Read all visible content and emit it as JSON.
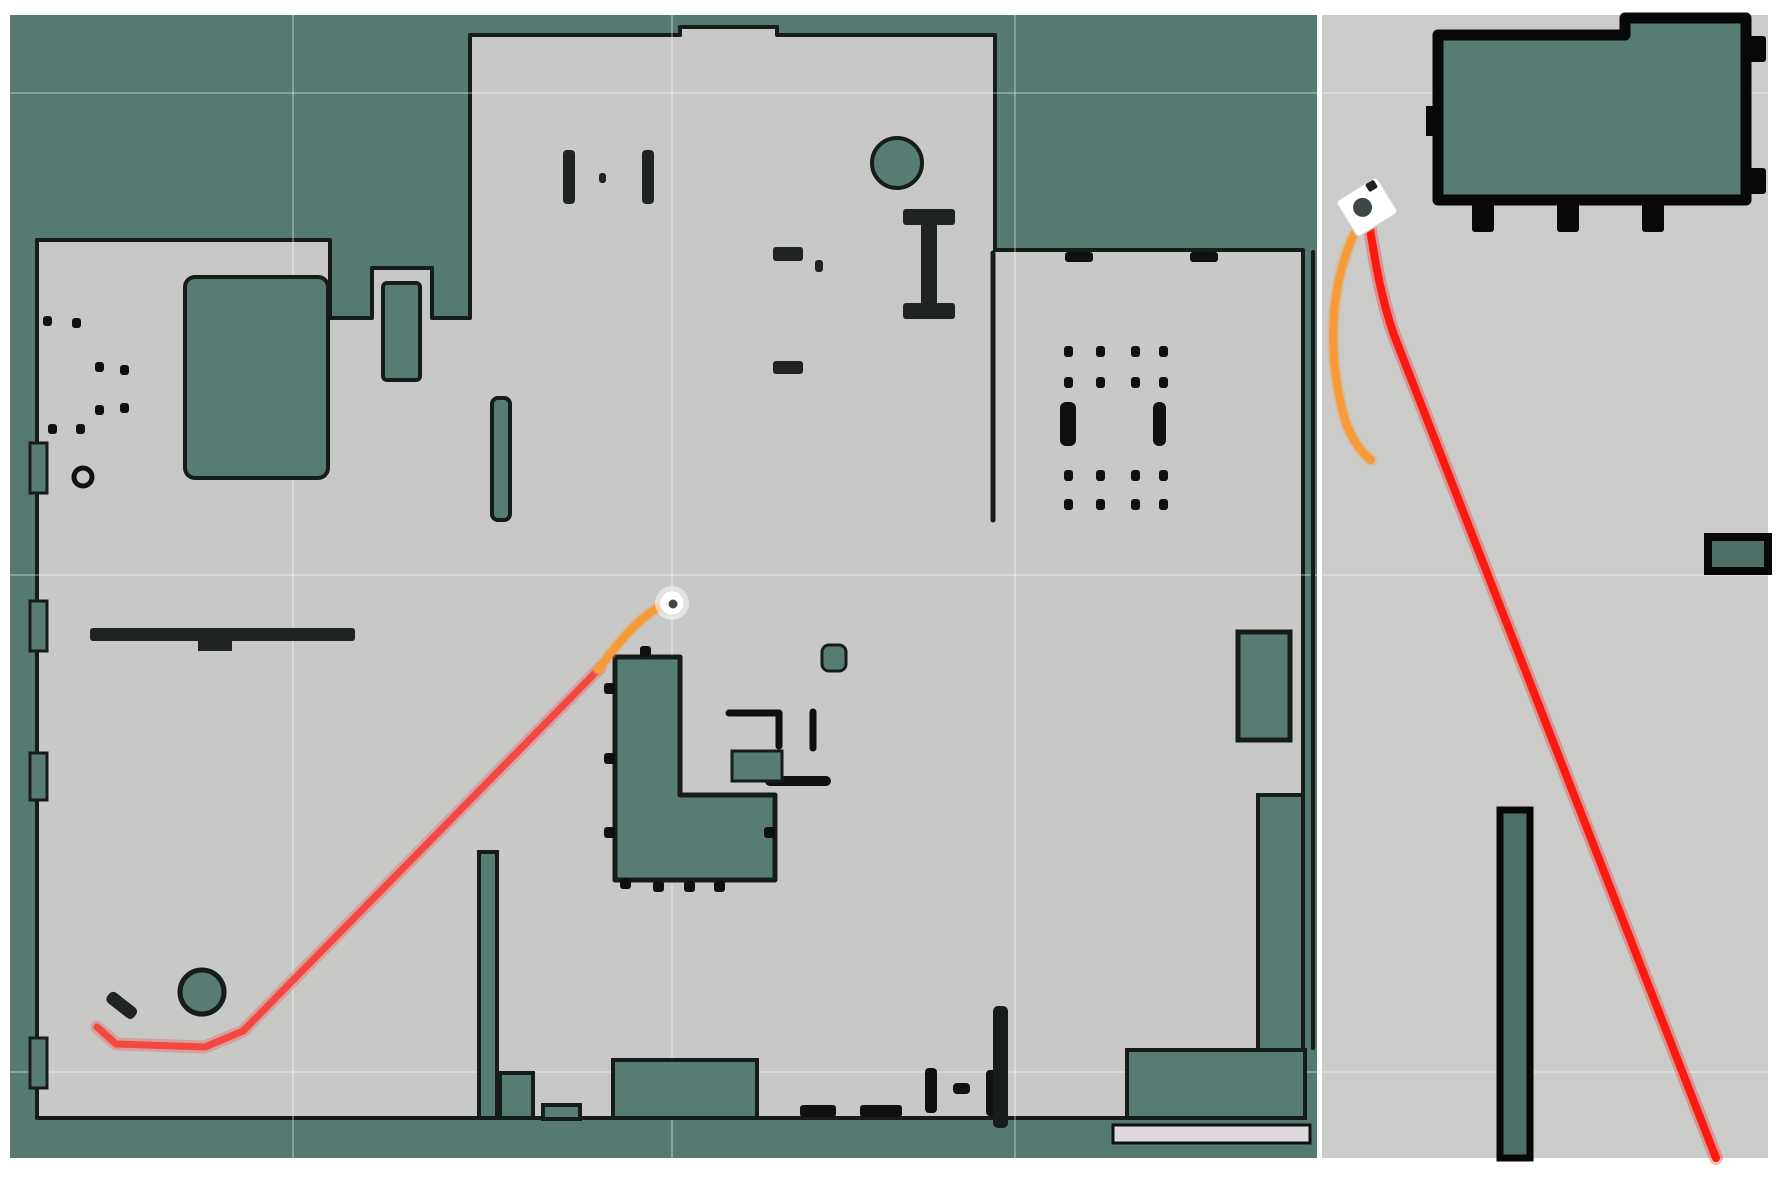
{
  "canvas": {
    "width": 1785,
    "height": 1185
  },
  "colors": {
    "margin": "#ffffff",
    "tealBg": "#557a71",
    "teal": "#567c73",
    "tealD": "#4d6f67",
    "freeL": "#c8c8c6",
    "freeR": "#cbcbc9",
    "wall": "#161c1a",
    "black": "#101010",
    "blackR": "#080808",
    "ink": "#1f2321",
    "light": "#dcd8dc",
    "red": "#f4473f",
    "redR": "#fb1a10",
    "orange": "#f79b38",
    "white": "#ffffff",
    "robotCore": "#40474a",
    "grid": "rgba(255,255,255,0.30)"
  },
  "panels": [
    {
      "name": "left-map-panel",
      "frame": {
        "x": 10,
        "y": 15,
        "w": 1307,
        "h": 1143
      },
      "bg": "tealBg",
      "free_space": {
        "d": "M37,240 L330,240 L330,318 L372,318 L372,268 L432,268 L432,318 L470,318 L470,35 L680,35 L680,27 L777,27 L777,35 L995,35 L995,250 L1303,250 L1303,1050 L1127,1050 L1127,1118 L37,1118 Z",
        "fill": "freeL",
        "stroke": "wall",
        "sw": 4
      },
      "grid": {
        "vx": [
          293,
          672,
          1015
        ],
        "hy": [
          93,
          575,
          1072
        ]
      },
      "shapes": [
        {
          "name": "inner-room-topleft",
          "kind": "rect",
          "x": 185,
          "y": 277,
          "w": 143,
          "h": 201,
          "rx": 10,
          "fill": "teal",
          "stroke": "wall",
          "sw": 4
        },
        {
          "name": "cabinet-top",
          "kind": "rect",
          "x": 383,
          "y": 283,
          "w": 37,
          "h": 97,
          "rx": 4,
          "fill": "teal",
          "stroke": "wall",
          "sw": 4
        },
        {
          "name": "round-column",
          "kind": "circle",
          "cx": 897,
          "cy": 163,
          "r": 25,
          "fill": "teal",
          "stroke": "wall",
          "sw": 4
        },
        {
          "name": "ibeam-cap-top",
          "kind": "rect",
          "x": 903,
          "y": 209,
          "w": 52,
          "h": 16,
          "rx": 3,
          "fill": "ink"
        },
        {
          "name": "ibeam-bar",
          "kind": "rect",
          "x": 921,
          "y": 216,
          "w": 16,
          "h": 94,
          "fill": "ink"
        },
        {
          "name": "ibeam-cap-bottom",
          "kind": "rect",
          "x": 903,
          "y": 303,
          "w": 52,
          "h": 16,
          "rx": 3,
          "fill": "ink"
        },
        {
          "name": "desk-mark",
          "kind": "rect",
          "x": 773,
          "y": 247,
          "w": 30,
          "h": 14,
          "rx": 3,
          "fill": "ink"
        },
        {
          "name": "desk-dot",
          "kind": "rect",
          "x": 815,
          "y": 260,
          "w": 8,
          "h": 12,
          "rx": 3,
          "fill": "ink"
        },
        {
          "name": "desk-mark-2",
          "kind": "rect",
          "x": 773,
          "y": 361,
          "w": 30,
          "h": 13,
          "rx": 3,
          "fill": "ink"
        },
        {
          "name": "pillar-bar-left",
          "kind": "rect",
          "x": 563,
          "y": 150,
          "w": 12,
          "h": 54,
          "rx": 4,
          "fill": "ink"
        },
        {
          "name": "pillar-bar-right",
          "kind": "rect",
          "x": 642,
          "y": 150,
          "w": 12,
          "h": 54,
          "rx": 4,
          "fill": "ink"
        },
        {
          "name": "pillar-dot",
          "kind": "rect",
          "x": 599,
          "y": 173,
          "w": 7,
          "h": 10,
          "rx": 3,
          "fill": "ink"
        },
        {
          "name": "kitchen-island",
          "kind": "path",
          "d": "M615,657 L680,657 L680,795 L775,795 L775,880 L615,880 Z",
          "fill": "teal",
          "stroke": "wall",
          "sw": 5
        },
        {
          "name": "island-tabs",
          "kind": "dots",
          "w": 11,
          "h": 11,
          "fill": "black",
          "pts": [
            [
              604,
              683
            ],
            [
              604,
              753
            ],
            [
              604,
              827
            ],
            [
              640,
              646
            ],
            [
              620,
              878
            ],
            [
              653,
              881
            ],
            [
              684,
              881
            ],
            [
              714,
              881
            ],
            [
              764,
              827
            ]
          ]
        },
        {
          "name": "counter-lines",
          "kind": "path",
          "d": "M729,713 L779,713 L779,746 M813,712 L813,748",
          "stroke": "black",
          "sw": 7
        },
        {
          "name": "counter-bar",
          "kind": "path",
          "d": "M770,781 L826,781",
          "stroke": "black",
          "sw": 10
        },
        {
          "name": "counter-box",
          "kind": "rect",
          "x": 732,
          "y": 751,
          "w": 50,
          "h": 30,
          "fill": "teal",
          "stroke": "wall",
          "sw": 3
        },
        {
          "name": "stool",
          "kind": "rect",
          "x": 822,
          "y": 645,
          "w": 24,
          "h": 26,
          "rx": 7,
          "fill": "teal",
          "stroke": "wall",
          "sw": 3
        },
        {
          "name": "cabinet-right-room",
          "kind": "rect",
          "x": 1238,
          "y": 632,
          "w": 52,
          "h": 108,
          "fill": "teal",
          "stroke": "wall",
          "sw": 5
        },
        {
          "name": "lband-vertical",
          "kind": "rect",
          "x": 1258,
          "y": 795,
          "w": 45,
          "h": 258,
          "fill": "teal",
          "stroke": "wall",
          "sw": 4
        },
        {
          "name": "lband-horizontal",
          "kind": "rect",
          "x": 1127,
          "y": 1050,
          "w": 178,
          "h": 68,
          "fill": "teal",
          "stroke": "wall",
          "sw": 4
        },
        {
          "name": "door-strip",
          "kind": "rect",
          "x": 1113,
          "y": 1125,
          "w": 197,
          "h": 18,
          "fill": "light",
          "stroke": "black",
          "sw": 3
        },
        {
          "name": "wall-segment-a",
          "kind": "rect",
          "x": 492,
          "y": 398,
          "w": 18,
          "h": 122,
          "rx": 6,
          "fill": "teal",
          "stroke": "wall",
          "sw": 4
        },
        {
          "name": "wall-segment-b",
          "kind": "rect",
          "x": 479,
          "y": 852,
          "w": 18,
          "h": 266,
          "fill": "teal",
          "stroke": "wall",
          "sw": 4
        },
        {
          "name": "bump-a",
          "kind": "rect",
          "x": 500,
          "y": 1073,
          "w": 33,
          "h": 45,
          "fill": "teal",
          "stroke": "wall",
          "sw": 4
        },
        {
          "name": "bump-b",
          "kind": "rect",
          "x": 543,
          "y": 1105,
          "w": 37,
          "h": 14,
          "fill": "teal",
          "stroke": "wall",
          "sw": 4
        },
        {
          "name": "stage-block",
          "kind": "rect",
          "x": 613,
          "y": 1060,
          "w": 144,
          "h": 58,
          "fill": "teal",
          "stroke": "wall",
          "sw": 4
        },
        {
          "name": "floor-dash-a",
          "kind": "rect",
          "x": 800,
          "y": 1105,
          "w": 36,
          "h": 12,
          "rx": 3,
          "fill": "black"
        },
        {
          "name": "floor-dash-b",
          "kind": "rect",
          "x": 860,
          "y": 1105,
          "w": 42,
          "h": 12,
          "rx": 3,
          "fill": "black"
        },
        {
          "name": "floor-tick-a",
          "kind": "rect",
          "x": 925,
          "y": 1068,
          "w": 12,
          "h": 45,
          "rx": 4,
          "fill": "black"
        },
        {
          "name": "floor-tick-b",
          "kind": "rect",
          "x": 953,
          "y": 1083,
          "w": 17,
          "h": 11,
          "rx": 4,
          "fill": "black"
        },
        {
          "name": "floor-tick-c",
          "kind": "rect",
          "x": 986,
          "y": 1070,
          "w": 11,
          "h": 46,
          "rx": 4,
          "fill": "black"
        },
        {
          "name": "wall-segment-c",
          "kind": "rect",
          "x": 993,
          "y": 1006,
          "w": 15,
          "h": 122,
          "rx": 5,
          "fill": "wall"
        },
        {
          "name": "round-obstacle",
          "kind": "circle",
          "cx": 202,
          "cy": 992,
          "r": 22,
          "fill": "teal",
          "stroke": "wall",
          "sw": 5
        },
        {
          "name": "angled-mark",
          "kind": "rect",
          "x": 105,
          "y": 999,
          "w": 34,
          "h": 13,
          "rx": 5,
          "fill": "ink",
          "rot": [
            38,
            122,
            1005
          ]
        },
        {
          "name": "shelf-bar",
          "kind": "rect",
          "x": 90,
          "y": 628,
          "w": 265,
          "h": 13,
          "rx": 3,
          "fill": "ink"
        },
        {
          "name": "shelf-step",
          "kind": "rect",
          "x": 198,
          "y": 640,
          "w": 34,
          "h": 11,
          "fill": "ink"
        },
        {
          "name": "room-divider-wall",
          "kind": "path",
          "d": "M1313,252 L1313,1048",
          "stroke": "wall",
          "sw": 4
        },
        {
          "name": "hall-right-wall",
          "kind": "path",
          "d": "M993,253 L993,520",
          "stroke": "wall",
          "sw": 5
        },
        {
          "name": "wall-tabs-top",
          "kind": "dots",
          "w": 28,
          "h": 10,
          "fill": "black",
          "pts": [
            [
              1065,
              252
            ],
            [
              1190,
              252
            ]
          ]
        },
        {
          "name": "pillar-dots-topleft",
          "kind": "dots",
          "w": 9,
          "h": 10,
          "fill": "black",
          "pts": [
            [
              43,
              316
            ],
            [
              72,
              318
            ],
            [
              95,
              362
            ],
            [
              120,
              365
            ],
            [
              95,
              405
            ],
            [
              120,
              403
            ],
            [
              48,
              424
            ],
            [
              76,
              424
            ]
          ]
        },
        {
          "name": "small-ring",
          "kind": "circle",
          "cx": 83,
          "cy": 477,
          "r": 9,
          "fill": "freeL",
          "stroke": "black",
          "sw": 5
        },
        {
          "name": "pillar-dots-right-room",
          "kind": "dots",
          "w": 9,
          "h": 11,
          "fill": "black",
          "pts": [
            [
              1064,
              346
            ],
            [
              1096,
              346
            ],
            [
              1131,
              346
            ],
            [
              1159,
              346
            ],
            [
              1064,
              377
            ],
            [
              1096,
              377
            ],
            [
              1131,
              377
            ],
            [
              1159,
              377
            ],
            [
              1064,
              470
            ],
            [
              1096,
              470
            ],
            [
              1131,
              470
            ],
            [
              1159,
              470
            ],
            [
              1064,
              499
            ],
            [
              1096,
              499
            ],
            [
              1131,
              499
            ],
            [
              1159,
              499
            ]
          ]
        },
        {
          "name": "bracket-a",
          "kind": "rect",
          "x": 1060,
          "y": 402,
          "w": 16,
          "h": 44,
          "rx": 6,
          "fill": "black"
        },
        {
          "name": "bracket-b",
          "kind": "rect",
          "x": 1153,
          "y": 402,
          "w": 13,
          "h": 44,
          "rx": 6,
          "fill": "black"
        },
        {
          "name": "wall-notch-1",
          "kind": "rect",
          "x": 30,
          "y": 443,
          "w": 17,
          "h": 50,
          "fill": "teal",
          "stroke": "wall",
          "sw": 3
        },
        {
          "name": "wall-notch-2",
          "kind": "rect",
          "x": 30,
          "y": 601,
          "w": 17,
          "h": 50,
          "fill": "teal",
          "stroke": "wall",
          "sw": 3
        },
        {
          "name": "wall-notch-3",
          "kind": "rect",
          "x": 30,
          "y": 753,
          "w": 17,
          "h": 47,
          "fill": "teal",
          "stroke": "wall",
          "sw": 3
        },
        {
          "name": "wall-notch-4",
          "kind": "rect",
          "x": 30,
          "y": 1038,
          "w": 17,
          "h": 50,
          "fill": "teal",
          "stroke": "wall",
          "sw": 3
        }
      ],
      "trajectories": [
        {
          "name": "planned-path-red",
          "d": "M97,1027 L116,1044 L205,1047 L243,1031 L600,668",
          "stroke": "red",
          "sw": 7,
          "halo": 13
        },
        {
          "name": "local-path-orange",
          "d": "M598,670 Q640,612 667,604",
          "stroke": "orange",
          "sw": 8,
          "halo": 12
        }
      ],
      "robot": {
        "type": "disc",
        "name": "robot-marker",
        "cx": 672,
        "cy": 603
      }
    },
    {
      "name": "right-map-panel",
      "frame": {
        "x": 1322,
        "y": 15,
        "w": 446,
        "h": 1143
      },
      "bg": "freeR",
      "free_space": null,
      "grid": {
        "vx": [],
        "hy": [
          93,
          575,
          1072
        ]
      },
      "shapes": [
        {
          "name": "room-outline",
          "kind": "path",
          "d": "M1438,35 L1625,35 L1625,18 L1746,18 L1746,200 L1438,200 Z",
          "fill": "teal",
          "stroke": "blackR",
          "sw": 11
        },
        {
          "name": "room-tabs-bottom",
          "kind": "dots",
          "w": 22,
          "h": 32,
          "fill": "blackR",
          "pts": [
            [
              1472,
              200
            ],
            [
              1557,
              200
            ],
            [
              1642,
              200
            ]
          ]
        },
        {
          "name": "room-tabs-right",
          "kind": "dots",
          "w": 20,
          "h": 26,
          "fill": "blackR",
          "pts": [
            [
              1746,
              36
            ],
            [
              1746,
              168
            ]
          ]
        },
        {
          "name": "room-tab-left",
          "kind": "rect",
          "x": 1426,
          "y": 106,
          "w": 14,
          "h": 30,
          "fill": "blackR"
        },
        {
          "name": "wall-stub-right",
          "kind": "rect",
          "x": 1708,
          "y": 537,
          "w": 60,
          "h": 34,
          "fill": "tealD",
          "stroke": "blackR",
          "sw": 8
        },
        {
          "name": "wall-bar-bottom",
          "kind": "rect",
          "x": 1500,
          "y": 810,
          "w": 30,
          "h": 348,
          "fill": "tealD",
          "stroke": "blackR",
          "sw": 7
        }
      ],
      "trajectories": [
        {
          "name": "planned-path-red",
          "d": "M1367,210 C1374,255 1380,295 1394,335 L1716,1158",
          "stroke": "redR",
          "sw": 8,
          "halo": 14
        },
        {
          "name": "local-path-orange",
          "d": "M1357,228 C1330,282 1326,352 1345,420 Q1355,448 1371,460",
          "stroke": "orange",
          "sw": 8,
          "halo": 12
        }
      ],
      "robot": {
        "type": "diamond",
        "name": "robot-marker",
        "cx": 1367,
        "cy": 207,
        "angle": -32
      }
    }
  ]
}
